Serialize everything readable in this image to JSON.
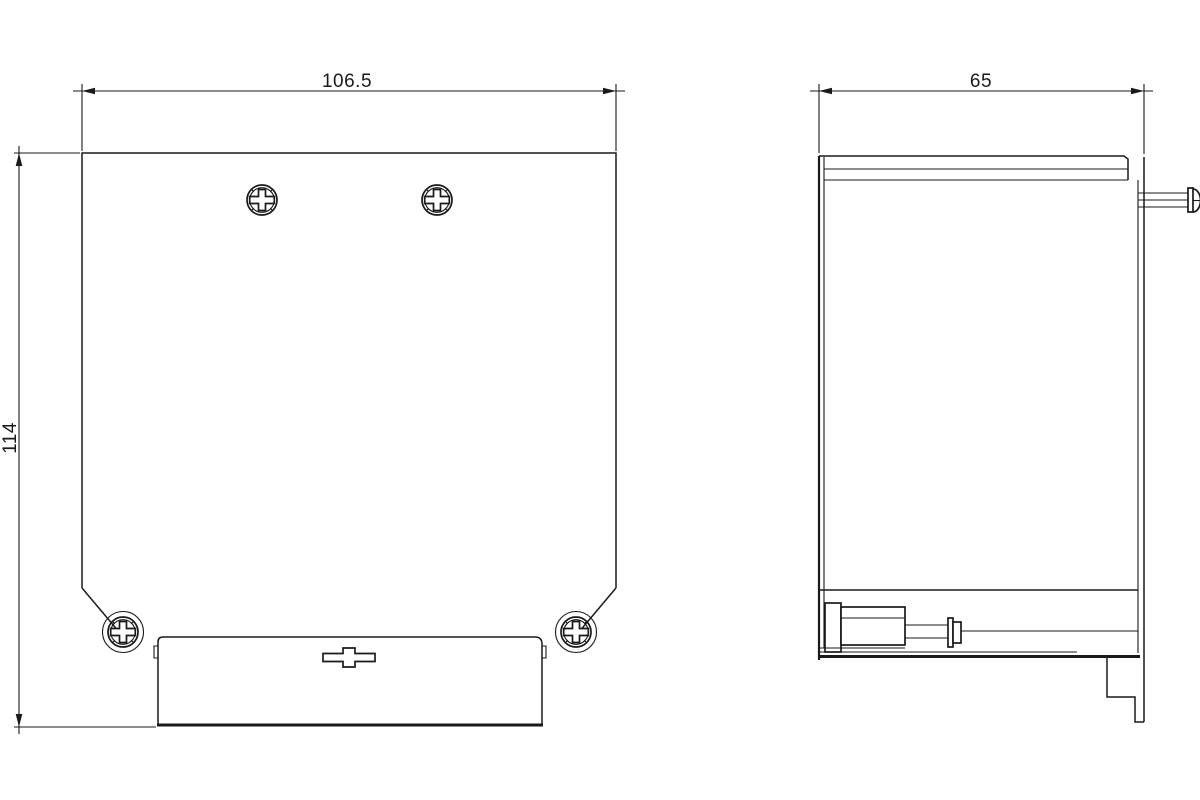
{
  "drawing": {
    "background_color": "#ffffff",
    "line_color": "#1a1a1a",
    "dimensions": {
      "front_width_mm": "106.5",
      "front_height_mm": "114",
      "side_depth_mm": "65"
    }
  }
}
